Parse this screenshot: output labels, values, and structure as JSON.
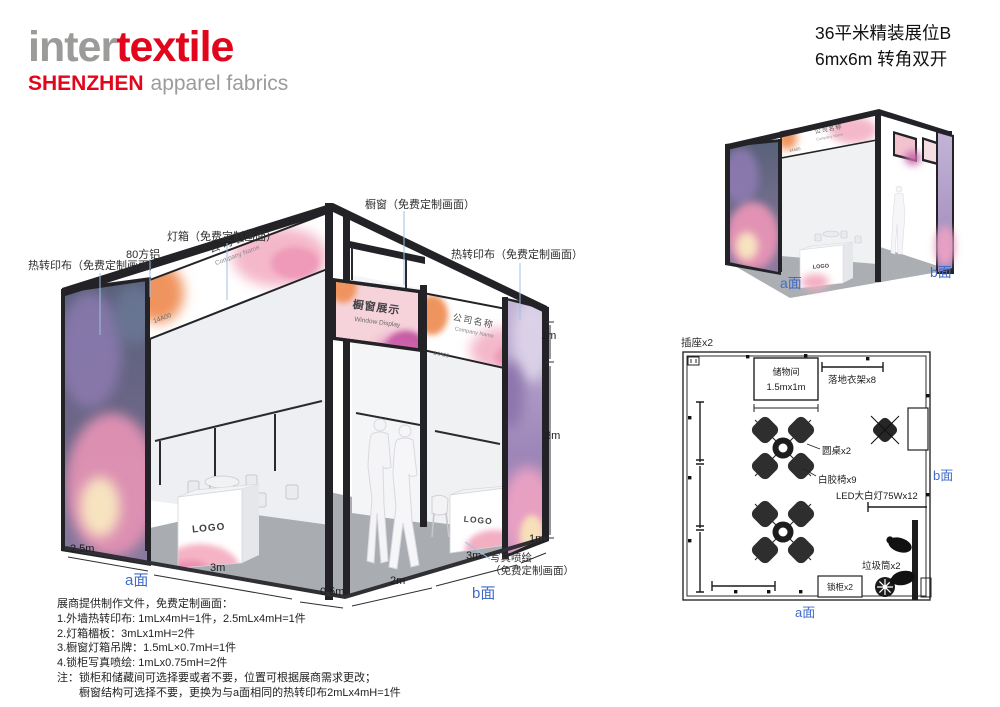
{
  "colors": {
    "brand_red": "#e2061c",
    "logo_gray": "#9b9b9a",
    "accent_blue": "#3f6cc8",
    "callout_line_blue": "#9cc2e6",
    "frame_black": "#232327",
    "floor_gray": "#a9adb2"
  },
  "header": {
    "logo": {
      "word1": "inter",
      "word2": "textile",
      "city": "SHENZHEN",
      "tagline": "apparel fabrics"
    },
    "title_line1": "36平米精装展位B",
    "title_line2": "6mx6m 转角双开"
  },
  "booth": {
    "fascia_cn": "公司名称",
    "fascia_en": "Company Name",
    "booth_no": "14A00",
    "window_sign_cn": "橱窗展示",
    "window_sign_en": "Window Display",
    "logo_text": "LOGO"
  },
  "callouts": {
    "left_fabric": "热转印布（免费定制画面）",
    "aluminum": "80方铝",
    "lightbox": "灯箱（免费定制画面）",
    "window": "橱窗（免费定制画面）",
    "right_fabric": "热转印布（免费定制画面）",
    "inkjet_line1": "写真喷绘",
    "inkjet_line2": "（免费定制画面）"
  },
  "dims": {
    "left_depth": "2.5m",
    "left_width": "3m",
    "gap": "0.5m",
    "right_width": "2m",
    "right_depth": "3m",
    "right_end": "1m",
    "fascia_height": "1m",
    "wall_height": "3m"
  },
  "labels": {
    "side_a": "a面",
    "side_b": "b面"
  },
  "floor_plan": {
    "socket": "插座x2",
    "storage_name": "储物间",
    "storage_size": "1.5mx1m",
    "rack": "落地衣架x8",
    "table": "圆桌x2",
    "chair": "白胶椅x9",
    "led": "LED大白灯75Wx12",
    "trash": "垃圾筒x2",
    "locker": "锁柜x2"
  },
  "notes": {
    "title": "展商提供制作文件，免费定制画面：",
    "item1": "1.外墙热转印布: 1mLx4mH=1件，2.5mLx4mH=1件",
    "item2": "2.灯箱楣板：3mLx1mH=2件",
    "item3": "3.橱窗灯箱吊牌：1.5mL×0.7mH=1件",
    "item4": "4.锁柜写真喷绘: 1mLx0.75mH=2件",
    "note1": "注：锁柜和储藏间可选择要或者不要，位置可根据展商需求更改；",
    "note2": "橱窗结构可选择不要，更换为与a面相同的热转印布2mLx4mH=1件"
  }
}
